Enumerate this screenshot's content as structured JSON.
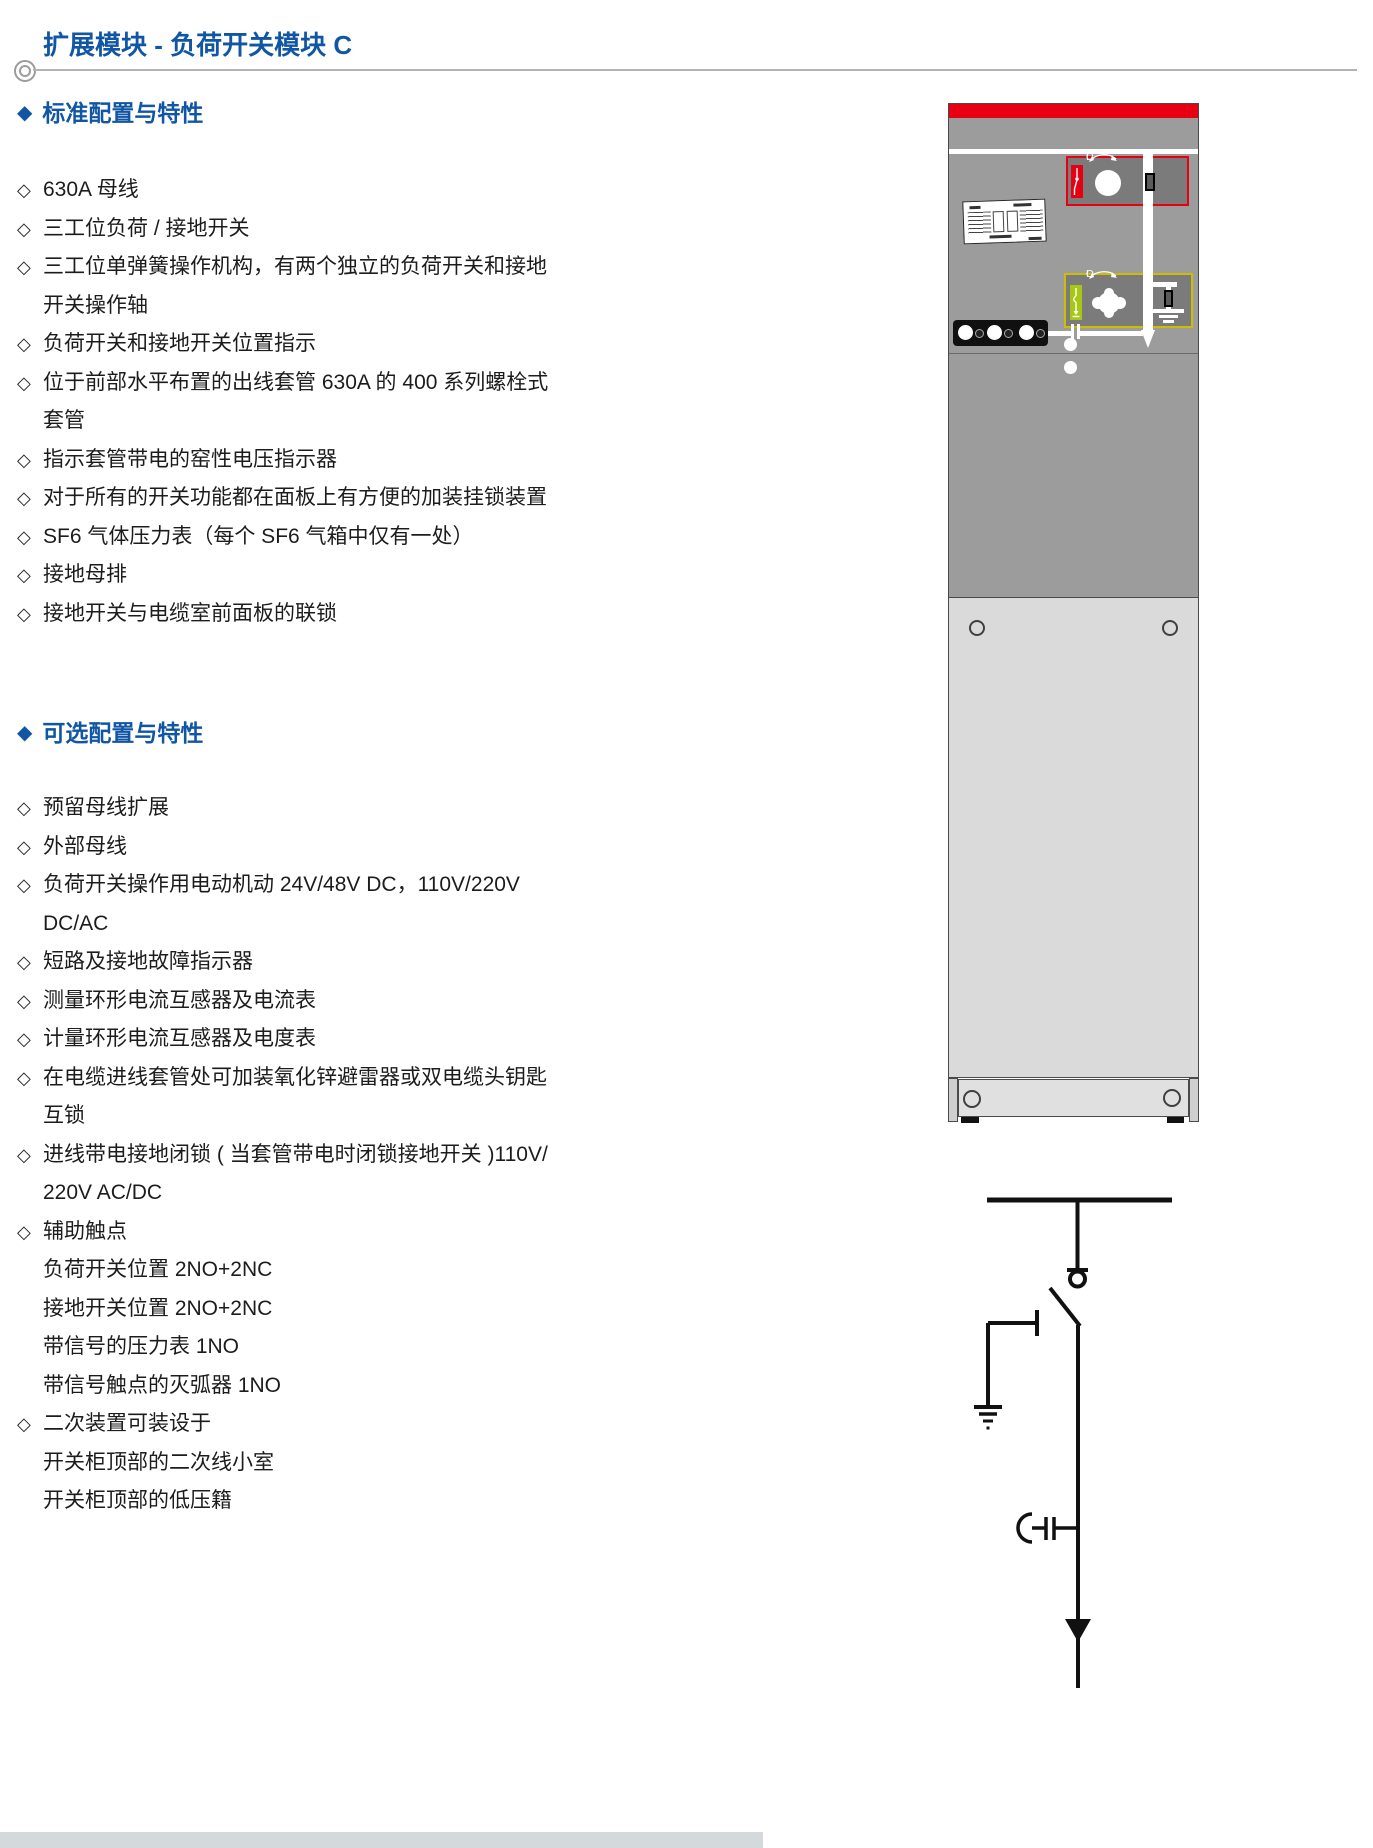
{
  "glyphs": {
    "section_bullet": "◆",
    "item_bullet": "◇"
  },
  "page": {
    "title": "扩展模块 - 负荷开关模块 C"
  },
  "sections": [
    {
      "heading": "标准配置与特性",
      "items": [
        {
          "text": "630A 母线"
        },
        {
          "text": "三工位负荷 / 接地开关"
        },
        {
          "text": "三工位单弹簧操作机构，有两个独立的负荷开关和接地\n开关操作轴"
        },
        {
          "text": "负荷开关和接地开关位置指示"
        },
        {
          "text": "位于前部水平布置的出线套管 630A 的 400 系列螺栓式\n套管"
        },
        {
          "text": "指示套管带电的窑性电压指示器"
        },
        {
          "text": "对于所有的开关功能都在面板上有方便的加装挂锁装置"
        },
        {
          "text": "SF6 气体压力表（每个 SF6 气箱中仅有一处）"
        },
        {
          "text": "接地母排"
        },
        {
          "text": "接地开关与电缆室前面板的联锁"
        }
      ]
    },
    {
      "heading": "可选配置与特性",
      "items": [
        {
          "text": "预留母线扩展"
        },
        {
          "text": "外部母线"
        },
        {
          "text": "负荷开关操作用电动机动 24V/48V DC，110V/220V\nDC/AC"
        },
        {
          "text": "短路及接地故障指示器"
        },
        {
          "text": "测量环形电流互感器及电流表"
        },
        {
          "text": "计量环形电流互感器及电度表"
        },
        {
          "text": "在电缆进线套管处可加装氧化锌避雷器或双电缆头钥匙\n互锁"
        },
        {
          "text": "进线带电接地闭锁 ( 当套管带电时闭锁接地开关 )110V/\n220V AC/DC"
        },
        {
          "text": "辅助触点\n负荷开关位置 2NO+2NC\n接地开关位置 2NO+2NC\n带信号的压力表 1NO\n带信号触点的灭弧器 1NO"
        },
        {
          "text": "二次装置可装设于\n开关柜顶部的二次线小室\n开关柜顶部的低压籍"
        }
      ]
    }
  ],
  "cabinet": {
    "load_switch": {
      "off_label": "O",
      "on_label": "I"
    },
    "earth_switch": {
      "off_label": "O",
      "on_label": "I"
    }
  },
  "colors": {
    "accent_blue": "#1156a4",
    "cabinet_red": "#e60012",
    "earth_green": "#a6c813"
  }
}
